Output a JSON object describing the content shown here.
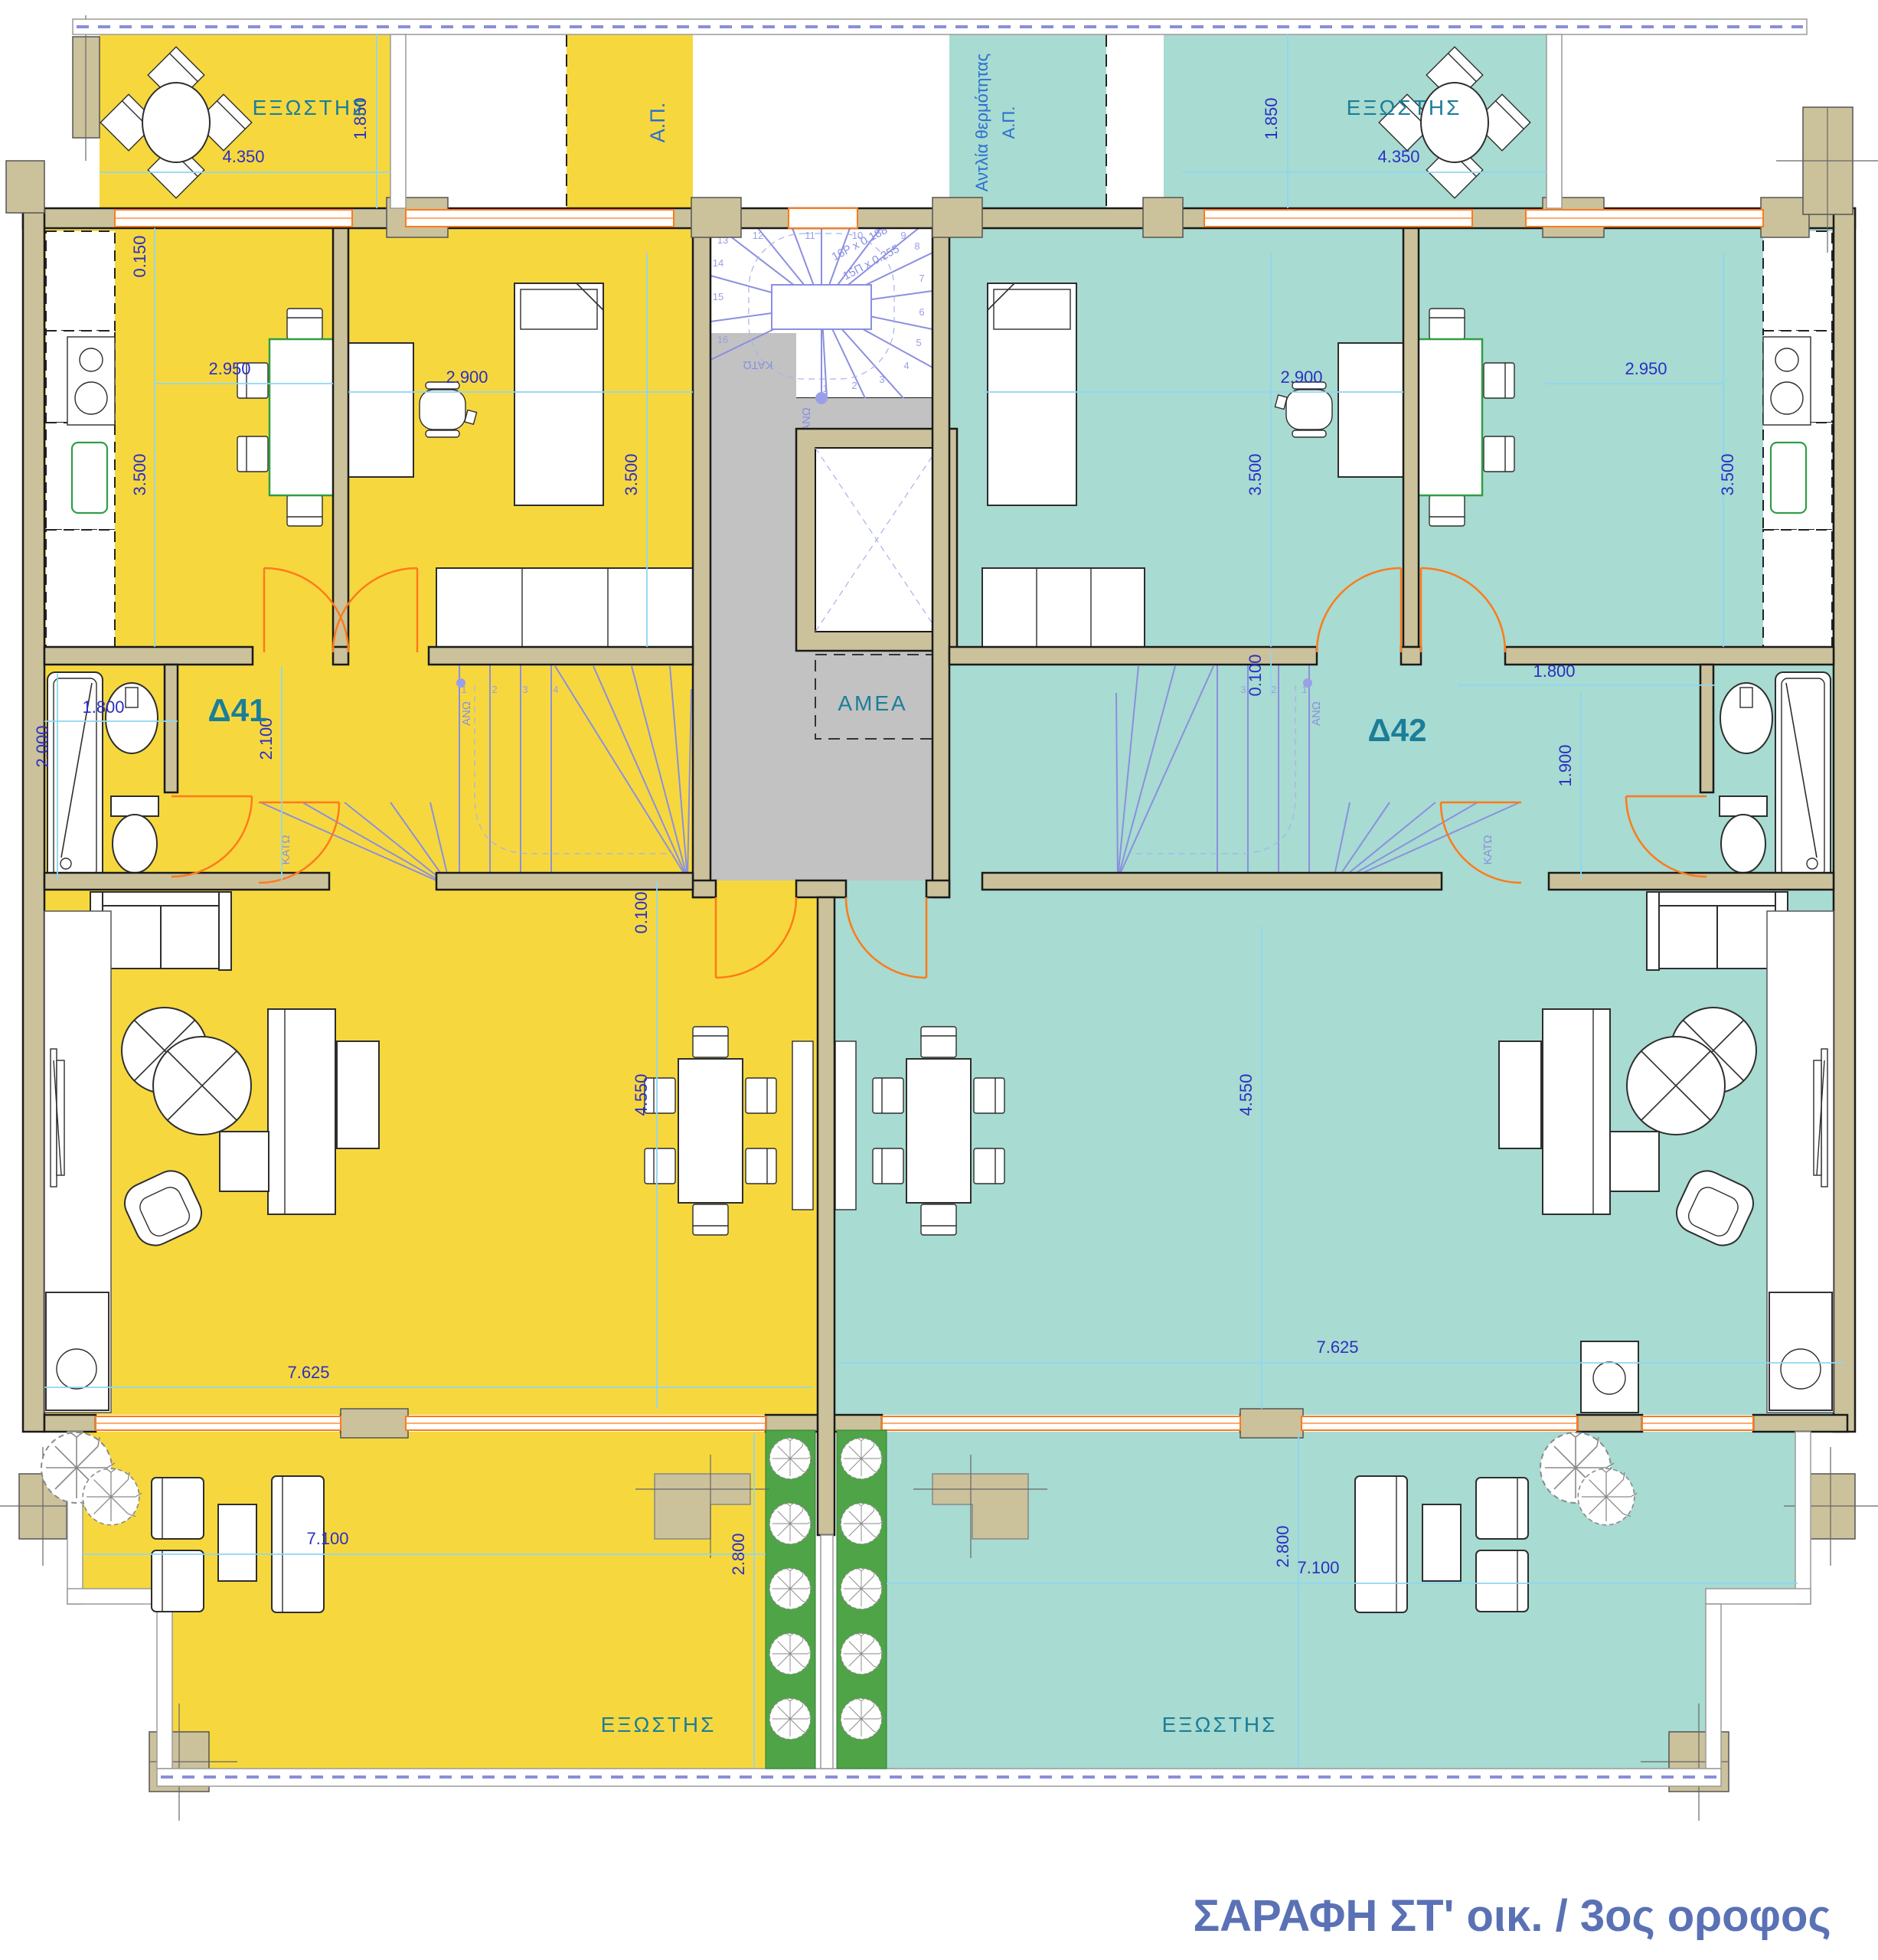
{
  "title": "ΣΑΡΑΦΗ ΣΤ' οικ. / 3ος οροφος",
  "apartments": {
    "left": {
      "name": "Δ41"
    },
    "right": {
      "name": "Δ42"
    }
  },
  "labels": {
    "balcony": "ΕΞΩΣΤΗΣ",
    "amea": "ΑΜΕΑ",
    "ap": "Α.Π.",
    "heat_pump_line1": "Αντλία θερμότητας",
    "heat_pump_line2": "Α.Π.",
    "stair_up": "ΑΝΩ",
    "stair_down": "ΚΑΤΩ"
  },
  "stair": {
    "spec_line1": "16Ρ x 0.188",
    "spec_line2": "15Π x 0.255",
    "treads": [
      "1",
      "2",
      "3",
      "4",
      "5",
      "6",
      "7",
      "8",
      "9",
      "10",
      "11",
      "12",
      "13",
      "14",
      "15",
      "16"
    ]
  },
  "dimensions": {
    "balcony_tl_width": "4.350",
    "balcony_tl_depth": "1.850",
    "balcony_tr_width": "4.350",
    "balcony_tr_depth": "1.850",
    "wall_offset_left": "0.150",
    "kitchen_left_width": "2.950",
    "kitchen_left_depth": "3.500",
    "bedroom_left_width": "2.900",
    "bedroom_left_depth": "3.500",
    "bedroom_right_width": "2.900",
    "bedroom_right_depth": "3.500",
    "kitchen_right_width": "2.950",
    "kitchen_right_depth": "3.500",
    "bath_left_length": "2.000",
    "bath_left_width": "1.800",
    "hall_left_depth": "2.100",
    "hall_right_width": "1.800",
    "hall_right_depth": "1.900",
    "living_left_offset": "0.100",
    "stair_right_offset": "0.100",
    "living_left_depth": "4.550",
    "living_right_depth": "4.550",
    "living_left_width": "7.625",
    "living_right_width": "7.625",
    "balcony_bl_width": "7.100",
    "balcony_bl_depth": "2.800",
    "balcony_br_width": "7.100",
    "balcony_br_depth": "2.800"
  },
  "colors": {
    "apartment_left": "#f6d83e",
    "apartment_right": "#a8dbd1",
    "walls": "#cbc19b",
    "core_floor": "#c2c2c2",
    "planter": "#4ea447",
    "doors": "#ff7a1a",
    "stairs": "#8b8fe0",
    "dimension_text": "#2b2fc4",
    "room_text": "#1b7e99",
    "title_text": "#5a71b5"
  }
}
